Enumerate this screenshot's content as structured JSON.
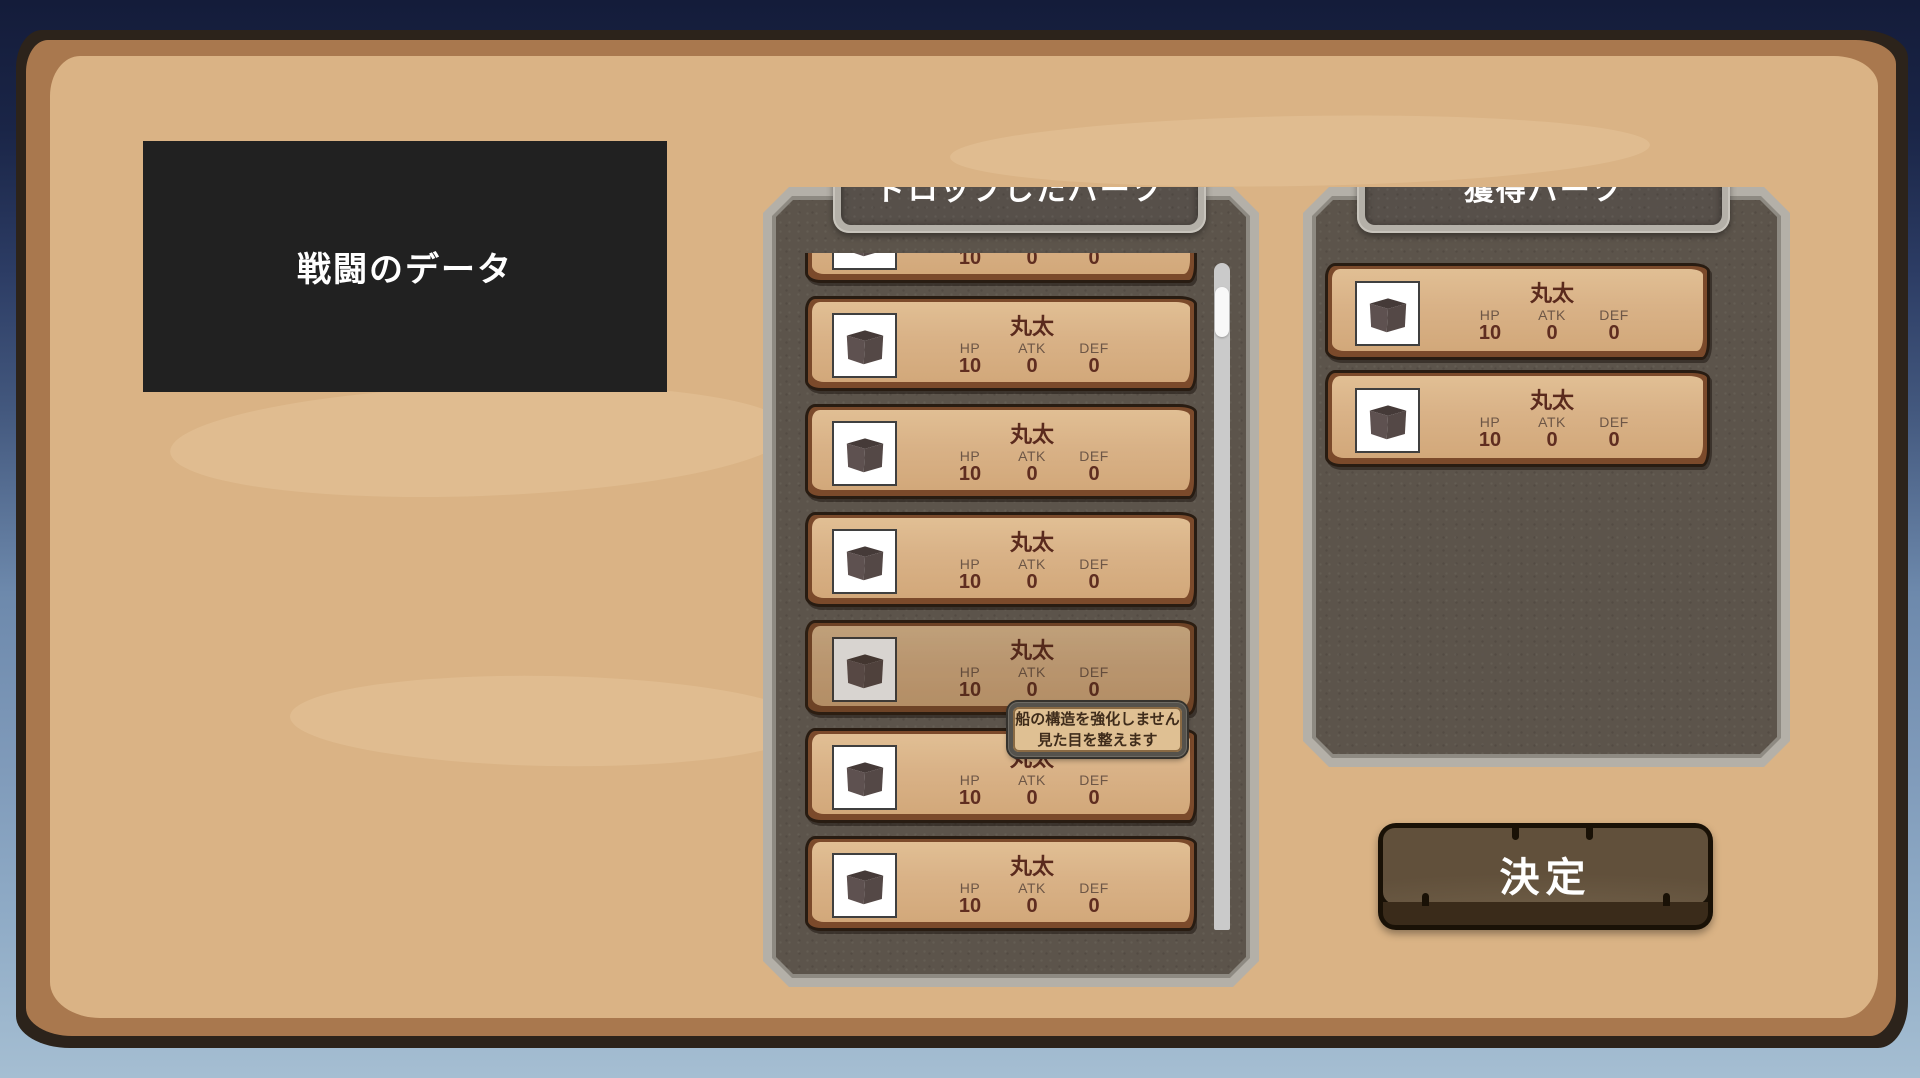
{
  "colors": {
    "night_sky": "#141c3a",
    "sea_light": "#a5bed2",
    "parchment": "#dab385",
    "parchment_border": "#a9784e",
    "panel_frame_gray": "#b4b0a8",
    "panel_interior_gray": "#5c544b",
    "card_fill": "#d9b287",
    "card_border_brown": "#7b4a2b",
    "text_dark_brown": "#5f2d20",
    "title_white": "#ffffff",
    "button_wood": "#63523d",
    "scrollbar_track": "#cacaca",
    "scrollbar_thumb": "#f8f8f8"
  },
  "icons": {
    "part": "wood-cube-icon"
  },
  "battle_data": {
    "label": "戦闘のデータ"
  },
  "dropped_panel": {
    "title": "ドロップしたパーツ",
    "items": [
      {
        "name": "丸太",
        "hp_label": "HP",
        "atk_label": "ATK",
        "def_label": "DEF",
        "hp": "10",
        "atk": "0",
        "def": "0"
      },
      {
        "name": "丸太",
        "hp_label": "HP",
        "atk_label": "ATK",
        "def_label": "DEF",
        "hp": "10",
        "atk": "0",
        "def": "0"
      },
      {
        "name": "丸太",
        "hp_label": "HP",
        "atk_label": "ATK",
        "def_label": "DEF",
        "hp": "10",
        "atk": "0",
        "def": "0"
      },
      {
        "name": "丸太",
        "hp_label": "HP",
        "atk_label": "ATK",
        "def_label": "DEF",
        "hp": "10",
        "atk": "0",
        "def": "0"
      },
      {
        "name": "丸太",
        "hp_label": "HP",
        "atk_label": "ATK",
        "def_label": "DEF",
        "hp": "10",
        "atk": "0",
        "def": "0"
      },
      {
        "name": "丸太",
        "hp_label": "HP",
        "atk_label": "ATK",
        "def_label": "DEF",
        "hp": "10",
        "atk": "0",
        "def": "0"
      },
      {
        "name": "丸太",
        "hp_label": "HP",
        "atk_label": "ATK",
        "def_label": "DEF",
        "hp": "10",
        "atk": "0",
        "def": "0"
      }
    ]
  },
  "acquired_panel": {
    "title": "獲得パーツ",
    "items": [
      {
        "name": "丸太",
        "hp_label": "HP",
        "atk_label": "ATK",
        "def_label": "DEF",
        "hp": "10",
        "atk": "0",
        "def": "0"
      },
      {
        "name": "丸太",
        "hp_label": "HP",
        "atk_label": "ATK",
        "def_label": "DEF",
        "hp": "10",
        "atk": "0",
        "def": "0"
      }
    ]
  },
  "tooltip": {
    "line1": "船の構造を強化しません",
    "line2": "見た目を整えます"
  },
  "confirm_button": {
    "label": "決定"
  }
}
